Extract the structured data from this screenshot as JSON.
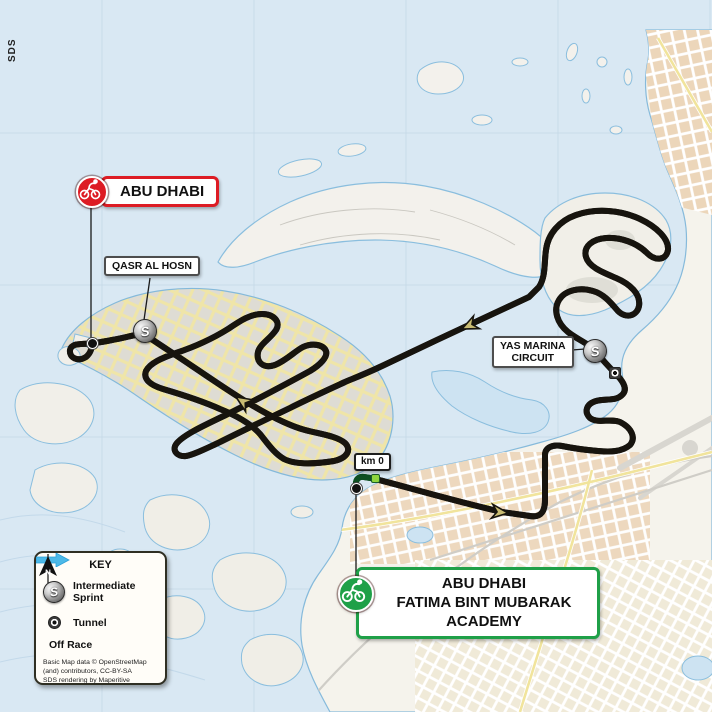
{
  "map": {
    "watermark": "SDS",
    "region": "Abu Dhabi race route map"
  },
  "labels": {
    "finish": {
      "text": "ABU DHABI"
    },
    "qasr_al_hosn": {
      "text": "QASR AL HOSN"
    },
    "yas_marina": {
      "line1": "YAS MARINA",
      "line2": "CIRCUIT"
    },
    "km0": {
      "text": "km 0"
    },
    "start": {
      "line1": "ABU DHABI",
      "line2": "FATIMA BINT MUBARAK",
      "line3": "ACADEMY"
    }
  },
  "key": {
    "title": "KEY",
    "sprint_glyph": "S",
    "compass_glyph": "N",
    "items": [
      {
        "icon": "sprint-icon",
        "label": "Intermediate Sprint"
      },
      {
        "icon": "tunnel-icon",
        "label": "Tunnel"
      },
      {
        "icon": "off-race-arrow-icon",
        "label": "Off Race"
      }
    ],
    "attribution_line1": "Basic Map data © OpenStreetMap",
    "attribution_line2": "(and) contributors, CC-BY-SA",
    "attribution_line3": "SDS rendering by Maperitive"
  },
  "colors": {
    "finish_red": "#dd1c24",
    "start_green": "#1fa048",
    "route_casing": "#17140e",
    "route_fill": "#c9bc72",
    "off_race_blue": "#4cb9e8",
    "water": "#d9e8f3"
  }
}
